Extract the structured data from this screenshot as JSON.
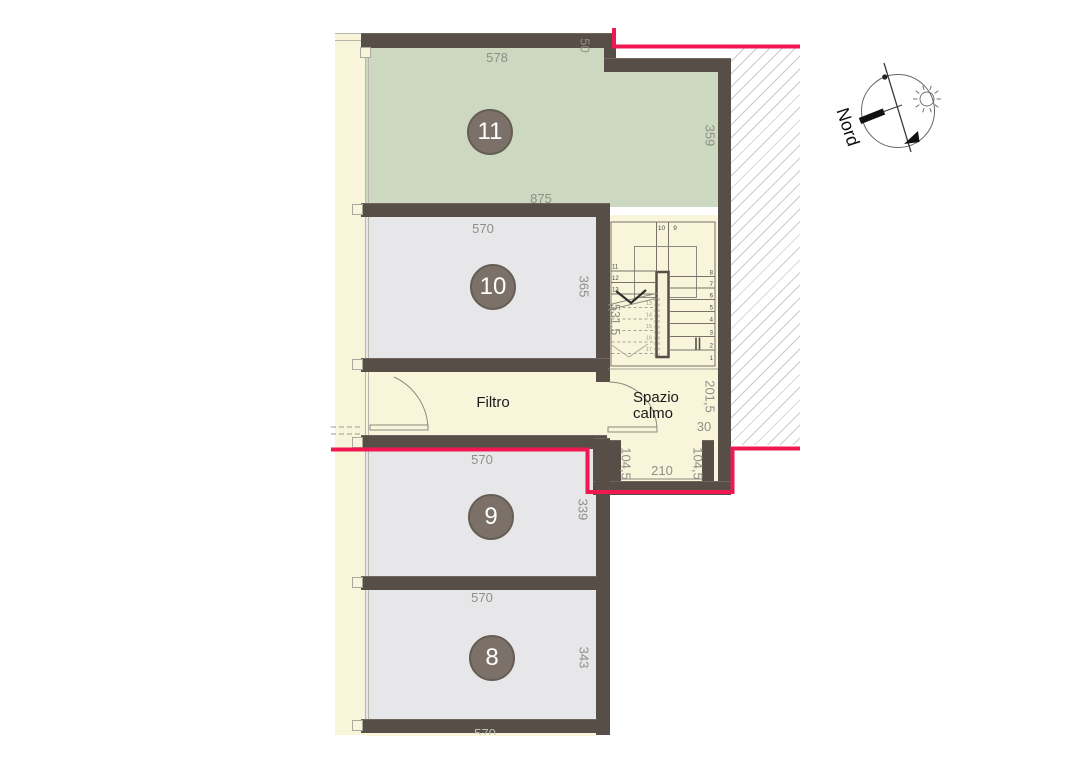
{
  "title": "floor-plan",
  "labels": {
    "filtro": "Filtro",
    "spazio_line1": "Spazio",
    "spazio_line2": "calmo",
    "nord": "Nord"
  },
  "badges": {
    "r11": "11",
    "r10": "10",
    "r9": "9",
    "r8": "8"
  },
  "dims": {
    "r11_top": "578",
    "r11_step": "50",
    "r11_right": "359",
    "r11_bottom": "875",
    "r10_top": "570",
    "r10_right": "365",
    "r9_top": "570",
    "r9_right": "339",
    "r8_top": "570",
    "r8_right": "343",
    "bottom_partial": "570",
    "stair": "531,5",
    "spazio_right": "201,5",
    "spazio_offset": "30",
    "vest_left": "104,5",
    "vest_center": "210",
    "vest_right": "104,5"
  },
  "stair": {
    "top": [
      "10",
      "9"
    ],
    "left_flight": [
      "11",
      "12",
      "13"
    ],
    "dashed_flight": [
      "13",
      "14",
      "15",
      "16",
      "17"
    ],
    "right_flight": [
      "8",
      "7",
      "6",
      "5",
      "4",
      "3",
      "2",
      "1"
    ]
  },
  "colors": {
    "escape_route_red": "#ef1850",
    "wall": "#574f47",
    "room_green": "#ccd8c0",
    "room_grey": "#e7e7e9",
    "circulation_yellow": "#f8f5da",
    "badge": "#7b7168",
    "dim_text": "#8f8f87"
  }
}
